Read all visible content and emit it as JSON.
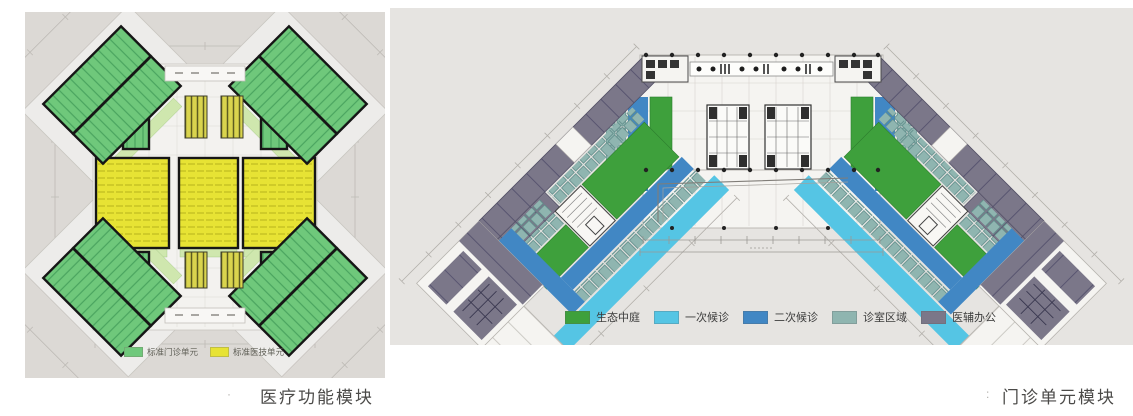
{
  "figures": {
    "left": {
      "caption": "医疗功能模块",
      "caption_marker": "·",
      "legend": {
        "items": [
          {
            "label": "标准门诊单元",
            "color": "#6fc87b"
          },
          {
            "label": "标准医技单元",
            "color": "#e7e334"
          }
        ]
      },
      "palette": {
        "outpatient_unit_green": "#6fc87b",
        "medtech_unit_yellow": "#e7e334",
        "corridor_light_green": "#cfe7ae"
      }
    },
    "right": {
      "caption": "门诊单元模块",
      "caption_marker": ":",
      "legend": {
        "items": [
          {
            "label": "生态中庭",
            "color": "#3ea03c"
          },
          {
            "label": "一次候诊",
            "color": "#55c5e4"
          },
          {
            "label": "二次候诊",
            "color": "#4187c4"
          },
          {
            "label": "诊室区域",
            "color": "#8fb5b0"
          },
          {
            "label": "医辅办公",
            "color": "#7b7789"
          }
        ]
      }
    }
  }
}
